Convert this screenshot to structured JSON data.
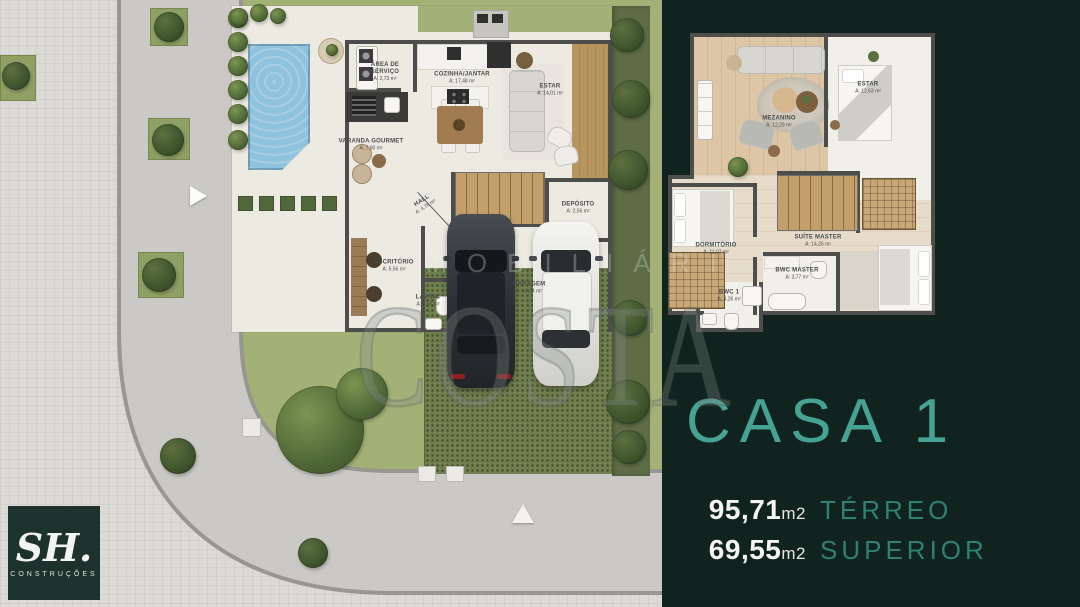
{
  "scene": {
    "type": "real-estate floor plan presentation",
    "house": "CASA 1"
  },
  "panel": {
    "title": "CASA 1",
    "areas": [
      {
        "value": "95,71",
        "unit": "m2",
        "label": "TÉRREO"
      },
      {
        "value": "69,55",
        "unit": "m2",
        "label": "SUPERIOR"
      }
    ]
  },
  "logo": {
    "initials": "SH.",
    "subtitle": "CONSTRUÇÕES"
  },
  "watermark": {
    "line1": "IMOBILIÁRIA",
    "line2": "COSTA"
  },
  "ground_floor": {
    "title": "Planta térreo",
    "rooms": [
      {
        "name": "ÁREA DE SERVIÇO",
        "area": "A: 2,73 m²"
      },
      {
        "name": "COZINHA/JANTAR",
        "area": "A: 17,48 m²"
      },
      {
        "name": "ESTAR",
        "area": "A: 14,01 m²"
      },
      {
        "name": "VARANDA GOURMET",
        "area": "A: 7,90 m²"
      },
      {
        "name": "HALL",
        "area": "A: 4,76 m²"
      },
      {
        "name": "DEPÓSITO",
        "area": "A: 2,56 m²"
      },
      {
        "name": "ESCRITÓRIO",
        "area": "A: 5,56 m²"
      },
      {
        "name": "LAV/WC",
        "area": "A: 3,55 m²"
      },
      {
        "name": "GARAGEM",
        "area": "A: 16,24 m²"
      }
    ]
  },
  "upper_floor": {
    "title": "Planta pavimento superior",
    "rooms": [
      {
        "name": "MEZANINO",
        "area": "A: 12,29 m²"
      },
      {
        "name": "ESTAR",
        "area": "A: 12,63 m²"
      },
      {
        "name": "DORMITÓRIO",
        "area": "A: 11,07 m²"
      },
      {
        "name": "SUÍTE MASTER",
        "area": "A: 14,26 m²"
      },
      {
        "name": "BWC MASTER",
        "area": "A: 3,77 m²"
      },
      {
        "name": "BWC 1",
        "area": "A: 4,26 m²"
      }
    ]
  },
  "colors": {
    "background": "#10231e",
    "accent": "#46a292",
    "accent_dim": "#2f8172",
    "text_white": "#f4f4f2",
    "floor": "#edeae2",
    "wall": "#4d4d4b",
    "lawn": "#a3b177",
    "pool": "#8fc2dc",
    "road": "#cac9c5",
    "sidewalk": "#dbdad6",
    "driveway_pavers": "#71804f",
    "wood": "#b0906a"
  }
}
